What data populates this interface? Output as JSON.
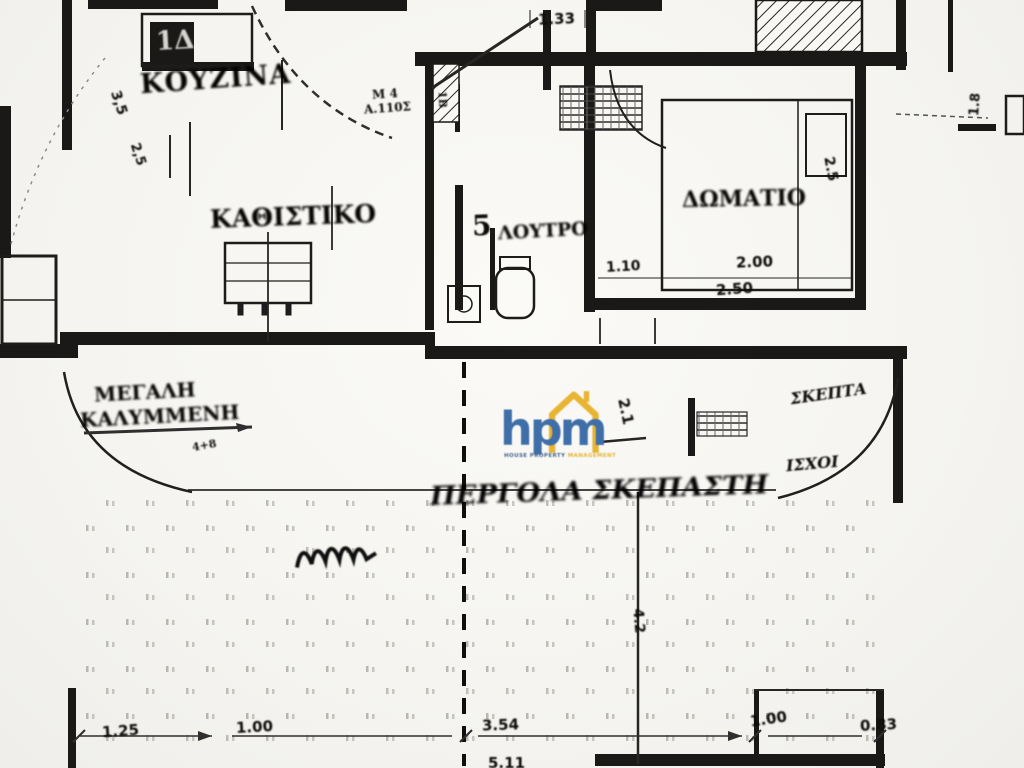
{
  "plan": {
    "rooms": {
      "kitchen": {
        "label": "ΚΟΥΖΙΝΑ",
        "appliance_label": "1Δ"
      },
      "living": {
        "label": "ΚΑΘΙΣΤΙΚΟ"
      },
      "bedroom": {
        "label": "ΔΩΜΑΤΙΟ"
      },
      "bathroom": {
        "number": "5",
        "label": "ΛΟΥΤΡΟ"
      },
      "hall": {
        "label_line1": "Μ 4",
        "label_line2": "Α.110Σ",
        "jamb_note": "1Β"
      }
    },
    "terrace": {
      "center_label": "ΠΕΡΓΟΛΑ ΣΚΕΠΑΣΤΗ",
      "left_label_line1": "ΜΕΓΑΛΗ",
      "left_label_line2": "ΚΑΛΥΜΜΕΝΗ",
      "left_note": "4+8",
      "right_label_top": "ΣΚΕΠΤΑ",
      "right_label_bottom": "ΙΣΧΟΙ"
    },
    "dimensions": {
      "top": "1.33",
      "top_right": "1.8",
      "kitchen_v1": "3,5",
      "kitchen_v2": "2,5",
      "bedroom_bottom": [
        "1.10",
        "2.00",
        "2.50"
      ],
      "bedroom_right": "2.5",
      "terrace_mid": "2.1",
      "terrace_right": "4.2",
      "bottom": [
        "1.25",
        "1.00",
        "3.54",
        "1.00",
        "0.83"
      ],
      "bottom_sub": "5.11"
    },
    "watermark": {
      "brand": "hpm",
      "tagline_main": "HOUSE PROPERTY",
      "tagline_accent": "MANAGEMENT",
      "brand_color": "#3f6fa8",
      "house_color": "#e8b432",
      "tagline_color": "#44658f"
    },
    "colors": {
      "paper": "#f7f6f2",
      "ink": "#1f1e1c"
    }
  }
}
